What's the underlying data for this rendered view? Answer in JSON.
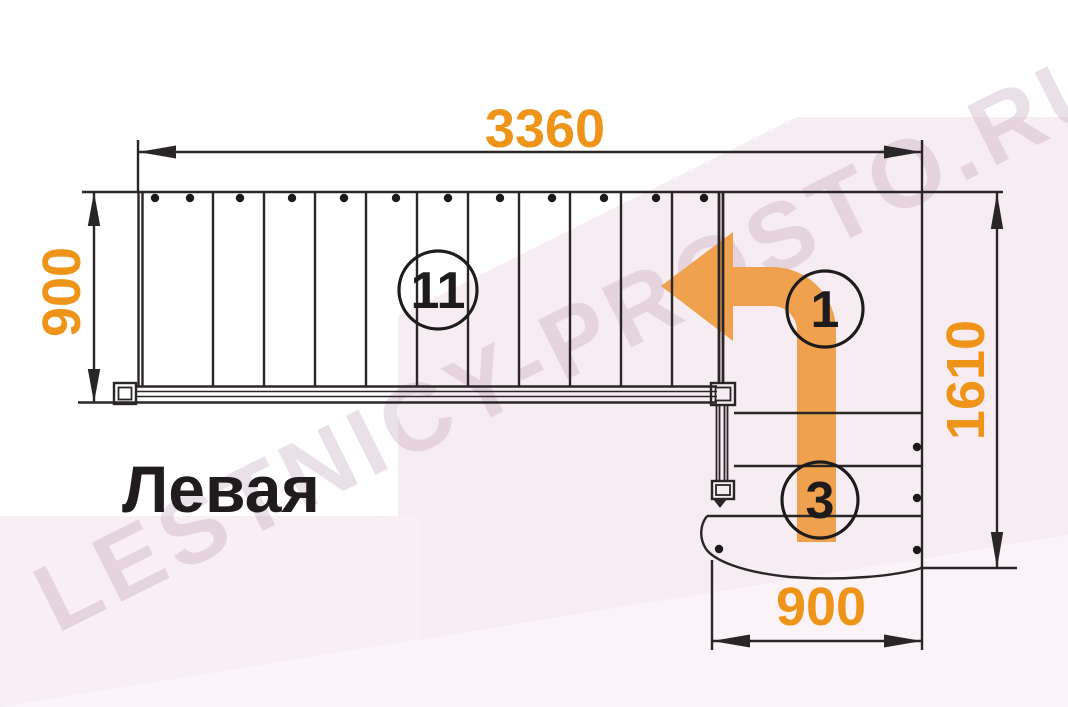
{
  "labels": {
    "title": "Левая"
  },
  "dimensions": {
    "top_width": "3360",
    "left_height": "900",
    "right_height": "1610",
    "bottom_width": "900"
  },
  "step_counts": {
    "main_flight": "11",
    "turn_arrow": "1",
    "lower_flight": "3"
  },
  "watermark": {
    "text": "LESTNICY-PROSTO.RU"
  },
  "colors": {
    "dimension_orange": "#ee9418",
    "arrow_orange": "#efa14e",
    "line_black": "#2a2628",
    "background_pink": "#f8ecf3",
    "title_black": "#201c1e"
  }
}
